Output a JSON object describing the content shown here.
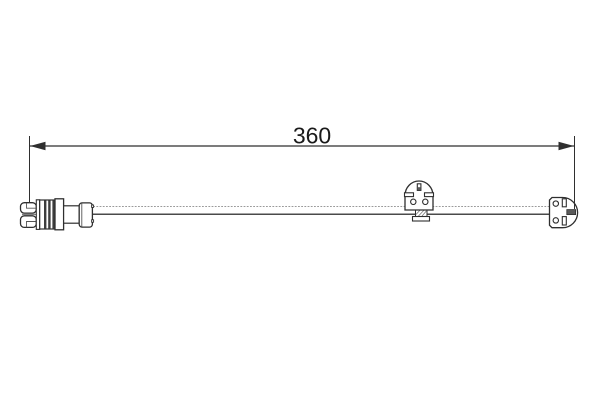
{
  "diagram": {
    "kind": "technical-part-drawing",
    "background_color": "#ffffff",
    "line_color": "#2f2f2f",
    "text_color": "#1a1a1a",
    "cable_top_line_color": "#9a9a9a",
    "cable_bottom_line_color": "#4a4a4a",
    "rib_fill_color": "#3d3d3d",
    "dark_slot_fill_color": "#5a5a5a",
    "dimension": {
      "label": "360"
    },
    "parts": {
      "left": "two-pin-connector-plug",
      "middle": "wear-sensor-clip",
      "right": "wear-sensor-end-clip",
      "link": "sensor-cable"
    }
  }
}
